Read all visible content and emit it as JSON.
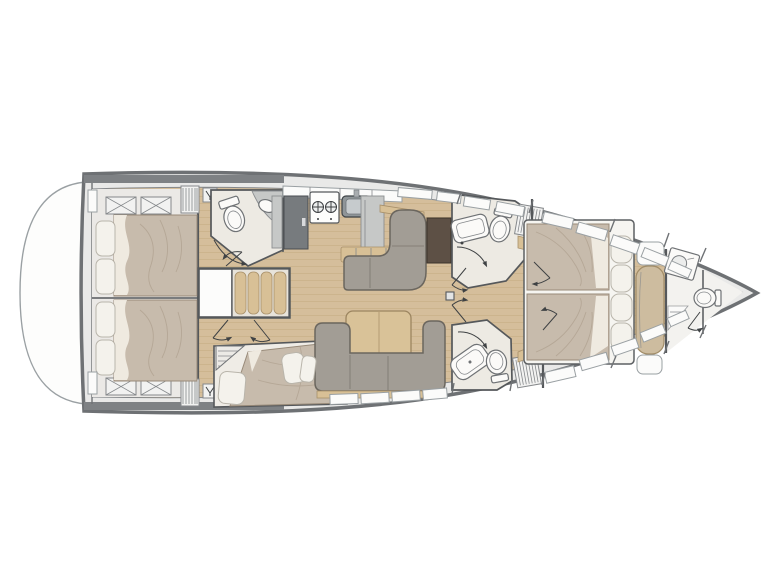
{
  "colors": {
    "hull_stroke": "#6e7174",
    "deck": "#e9e9e8",
    "deck_line": "#9aa0a3",
    "platform": "#fdfdfc",
    "bar": "#7e8184",
    "wood": "#d5be9b",
    "wood_line": "#c4aa80",
    "wood_trim": "#d8c096",
    "cabin_floor": "#ebe9e6",
    "cream": "#edeae3",
    "forepeak_floor": "#f3f2ef",
    "wall": "#55585b",
    "mattress": "#c7bbac",
    "mattress_shade": "#a89a87",
    "bed_base": "#f6f5f1",
    "pillow": "#f4f2ec",
    "pillow_stroke": "#b9b5ab",
    "sofa": "#a29d95",
    "sofa_stroke": "#6b665e",
    "table": "#d9c298",
    "table_stroke": "#9c8560",
    "counter": "#c6c8c7",
    "counter_stroke": "#8b8e90",
    "appliance": "#777b7e",
    "appliance_stroke": "#4a4e51",
    "sink": "#8f9598",
    "steel": "#c6cbcd",
    "brown_panel": "#5d5045",
    "white": "#fbfbfa",
    "fixture_stroke": "#6f7275",
    "hatch_stroke": "#85888b",
    "door_line": "#3f4244",
    "bench": "#cdbc9f",
    "bench_stroke": "#a18c67"
  },
  "icons": [
    "toilet-icon",
    "sink-icon",
    "stove-burner-icon",
    "fridge-icon",
    "shower-tray-icon",
    "door-swing-icon",
    "deck-hatch-icon",
    "louver-vent-icon",
    "vent-fitting-icon",
    "companionway-steps-icon",
    "mast-foot-icon"
  ]
}
